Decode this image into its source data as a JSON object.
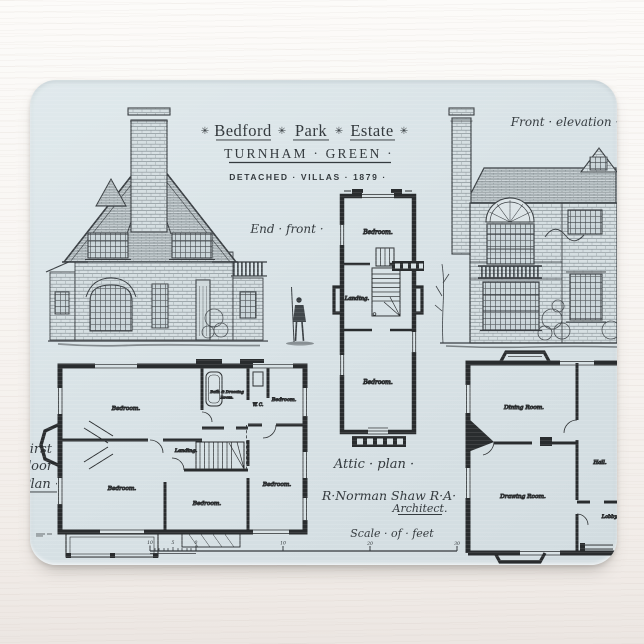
{
  "artwork": {
    "ornament": "✳",
    "title_words": [
      "Bedford",
      "Park",
      "Estate"
    ],
    "subtitle": "TURNHAM · GREEN ·",
    "detached_line": "DETACHED · VILLAS ·  1879 ·",
    "labels": {
      "front_elevation": "Front · elevation ·",
      "end_front": "End · front ·",
      "attic_plan": "Attic · plan ·",
      "architect_name": "R·Norman Shaw R·A·",
      "architect_title": "Architect.",
      "scale_of_feet": "Scale · of · feet",
      "first_floor": [
        "First",
        "floor",
        "Plan ·"
      ]
    },
    "rooms": {
      "attic": {
        "bedroom_top": "Bedroom.",
        "landing": "Landing.",
        "bedroom_bottom": "Bedroom."
      },
      "first_floor": {
        "bedroom_nw": "Bedroom.",
        "bath_line1": "Bath & Dressing",
        "bath_line2": "Room.",
        "wc": "W. C.",
        "bedroom_ne": "Bedroom.",
        "landing": "Landing.",
        "bedroom_sw": "Bedroom.",
        "bedroom_s": "Bedroom.",
        "bedroom_e": "Bedroom."
      },
      "ground_floor": {
        "dining": "Dining Room.",
        "hall": "Hall.",
        "drawing": "Drawing Room.",
        "lobby": "Lobby."
      }
    },
    "scale_ticks": [
      "10",
      "5",
      "0",
      "10",
      "20",
      "30"
    ],
    "colors": {
      "pad": "#d8e1e4",
      "ink": "#353b3f",
      "wall": "#292c2e"
    }
  }
}
